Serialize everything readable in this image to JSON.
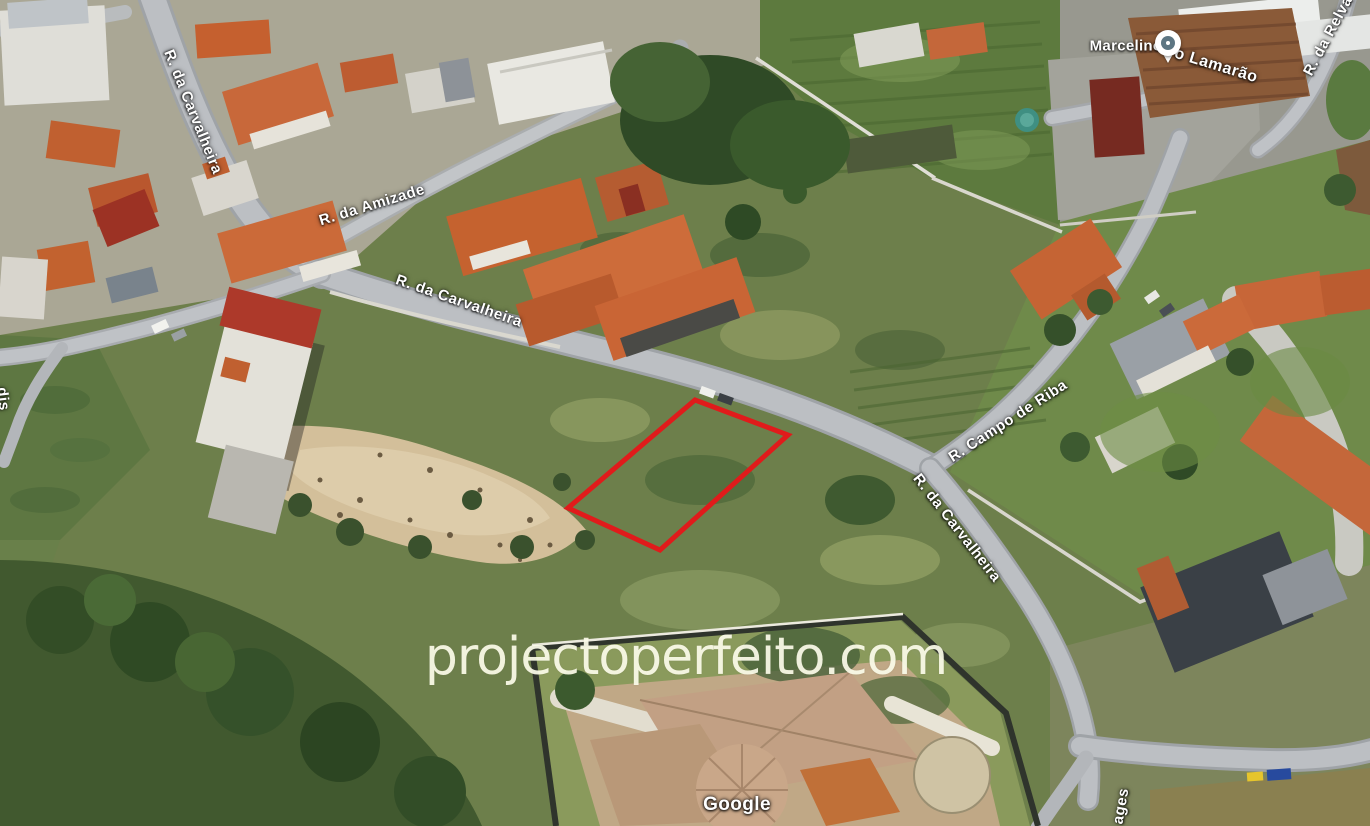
{
  "map_view": {
    "description": "3D aerial satellite view of a residential neighborhood with a building plot outlined in red",
    "attribution": "Google",
    "watermark": "projectoperfeito.com",
    "poi": {
      "label": "Marcelino",
      "icon": "map-pin-icon",
      "pin_outer_color": "#ffffff",
      "pin_inner_color": "#5d7683"
    },
    "street_labels": [
      {
        "id": "carvalheira-west",
        "text": "R. da Carvalheira"
      },
      {
        "id": "amizade",
        "text": "R. da Amizade"
      },
      {
        "id": "carvalheira-mid",
        "text": "R. da Carvalheira"
      },
      {
        "id": "campo-de-riba",
        "text": "R. Campo de Riba"
      },
      {
        "id": "carvalheira-east",
        "text": "R. da Carvalheira"
      },
      {
        "id": "lamarao",
        "text": "o Lamarão"
      },
      {
        "id": "relva",
        "text": "R. da Relva"
      },
      {
        "id": "partial-left-edge",
        "text": "dis"
      },
      {
        "id": "partial-bottom",
        "text": "ages"
      }
    ],
    "plot_highlight": {
      "shape": "quadrilateral",
      "stroke_color": "#e01b1b",
      "stroke_width": 5,
      "points_px": [
        [
          695,
          400
        ],
        [
          788,
          435
        ],
        [
          660,
          550
        ],
        [
          568,
          508
        ]
      ]
    },
    "colors": {
      "terrain_green": "#6d7f4b",
      "roof_terracotta": "#c8683a",
      "road_gray": "#b6b9bd",
      "sand_patch": "#d3bf9a",
      "plowed_field": "#ab8f72",
      "watermark_text": "#fbfbe9"
    }
  }
}
